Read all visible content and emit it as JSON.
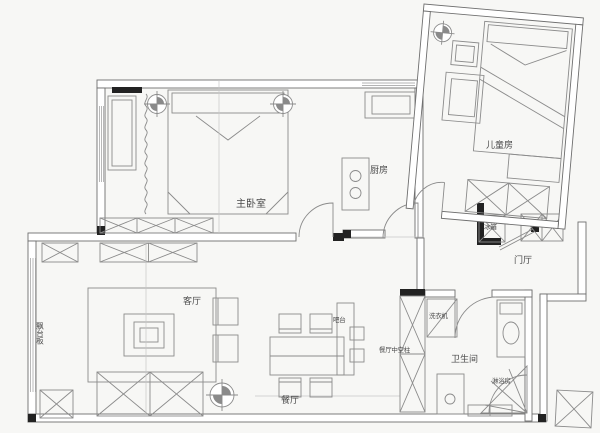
{
  "figure": {
    "type": "apartment-floor-plan",
    "colors": {
      "background": "#f7f7f5",
      "line": "#8b8b8b",
      "wall_outline": "#6e6e6e",
      "solid_wall_fill": "#222222",
      "text": "#4a4a4a"
    },
    "rooms": {
      "master_bedroom": "主卧室",
      "kids_room": "儿童房",
      "kitchen": "厨房",
      "foyer": "门厅",
      "living_room": "客厅",
      "dining_room": "餐厅",
      "bathroom": "卫生间"
    },
    "annotations": {
      "bay_window_board": "飘台板",
      "bar_counter": "吧台",
      "dining_column": "餐厅中空柱",
      "fridge": "冰箱",
      "washing_machine": "洗衣机",
      "shower_room": "淋浴房"
    }
  }
}
